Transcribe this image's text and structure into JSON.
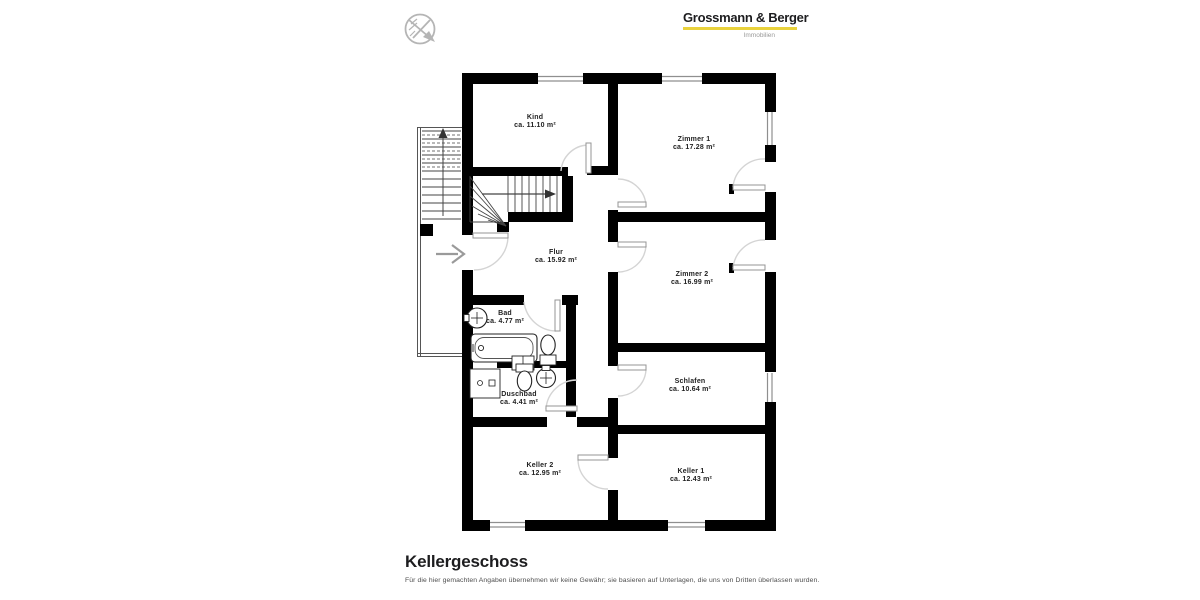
{
  "branding": {
    "logo_title": "Grossmann & Berger",
    "logo_subtitle": "Immobilien",
    "accent_color": "#e9d23c"
  },
  "icons": {
    "compass": "compass-icon",
    "entrance_arrow": "entrance-arrow-icon",
    "stair_up_arrow": "stair-direction-arrow-icon"
  },
  "plan": {
    "wall_color": "#000000",
    "rooms": [
      {
        "name": "Kind",
        "area": "ca. 11.10 m²",
        "cx": 535,
        "cy": 122
      },
      {
        "name": "Zimmer 1",
        "area": "ca. 17.28 m²",
        "cx": 694,
        "cy": 144
      },
      {
        "name": "Flur",
        "area": "ca. 15.92 m²",
        "cx": 556,
        "cy": 257
      },
      {
        "name": "Zimmer 2",
        "area": "ca. 16.99 m²",
        "cx": 692,
        "cy": 279
      },
      {
        "name": "Bad",
        "area": "ca. 4.77 m²",
        "cx": 505,
        "cy": 318
      },
      {
        "name": "Schlafen",
        "area": "ca. 10.64 m²",
        "cx": 690,
        "cy": 386
      },
      {
        "name": "Duschbad",
        "area": "ca. 4.41 m²",
        "cx": 519,
        "cy": 399
      },
      {
        "name": "Keller 2",
        "area": "ca. 12.95 m²",
        "cx": 540,
        "cy": 470
      },
      {
        "name": "Keller 1",
        "area": "ca. 12.43 m²",
        "cx": 691,
        "cy": 476
      }
    ]
  },
  "footer": {
    "title": "Kellergeschoss",
    "disclaimer": "Für die hier gemachten Angaben übernehmen wir keine Gewähr; sie basieren auf Unterlagen, die uns von Dritten überlassen wurden."
  }
}
